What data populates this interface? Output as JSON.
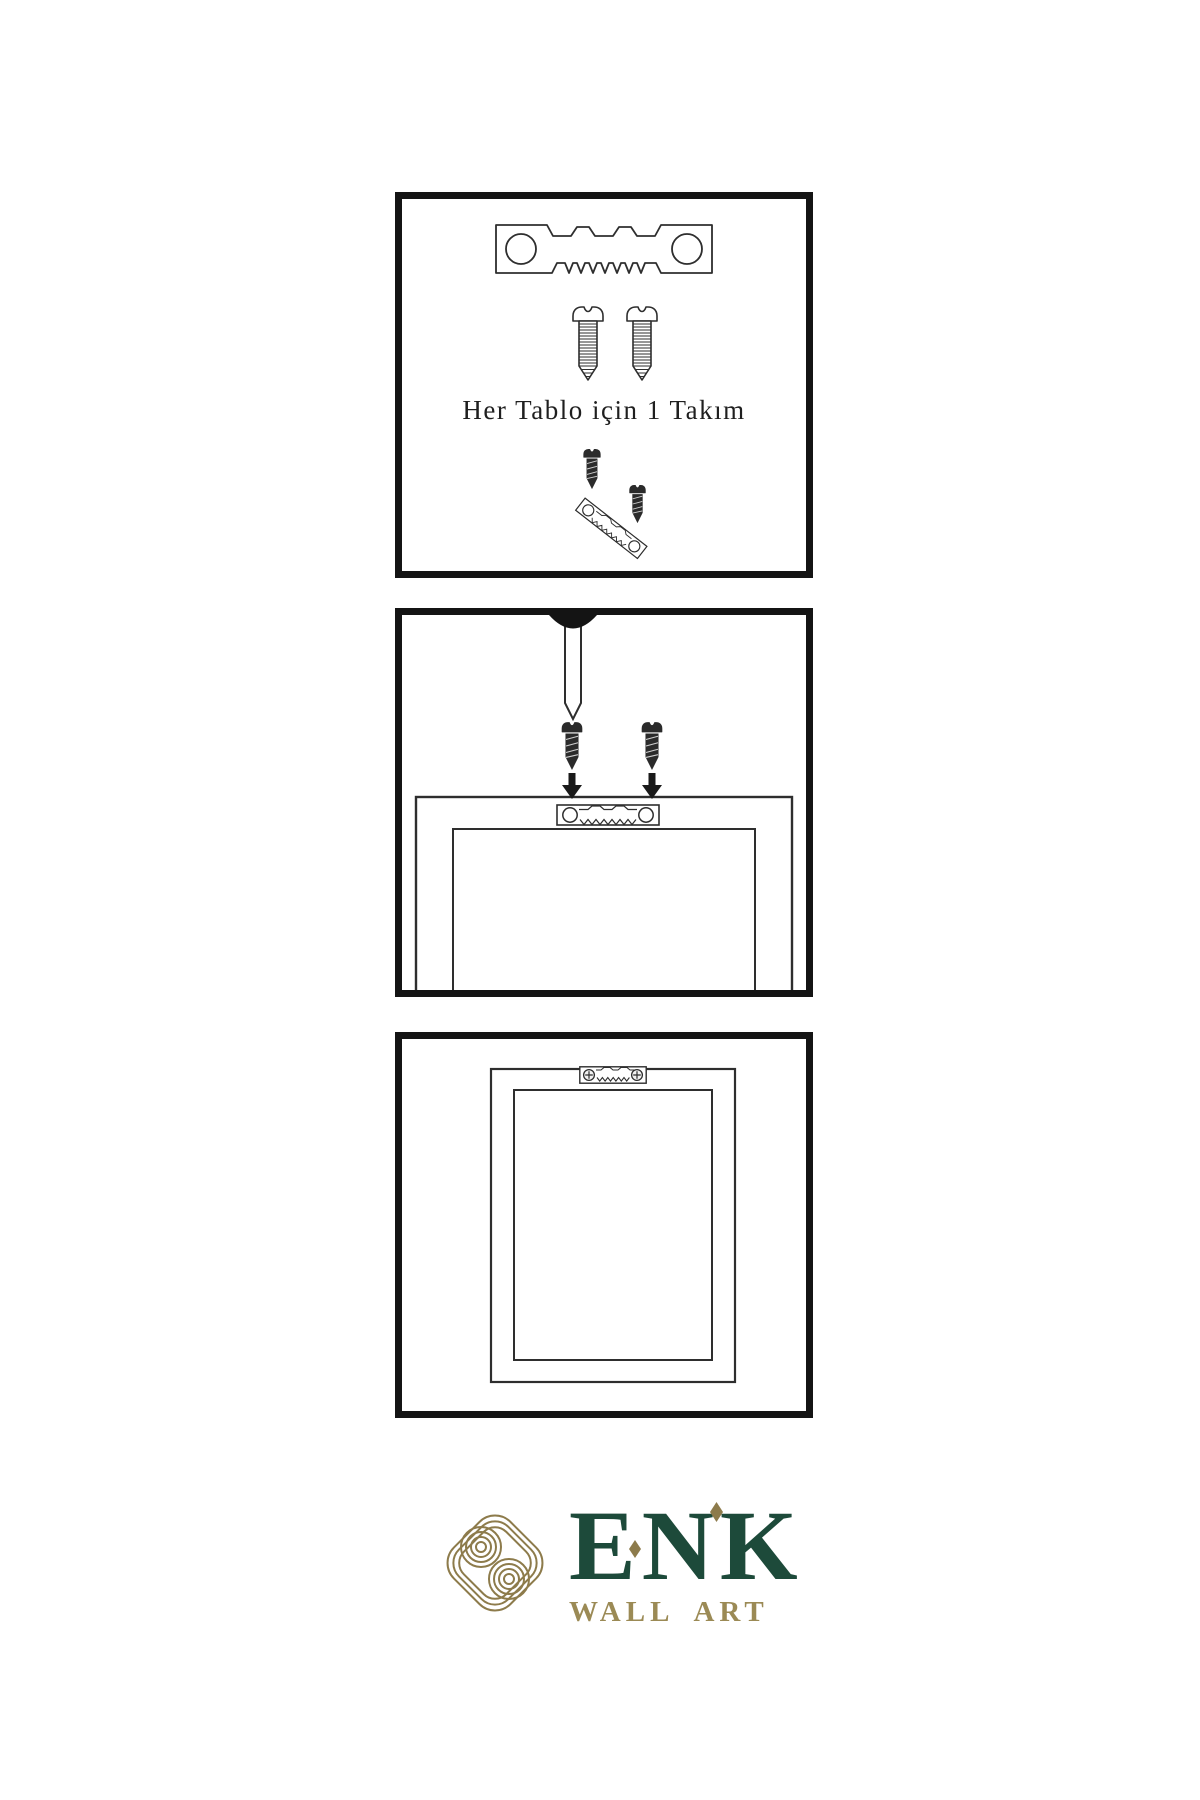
{
  "colors": {
    "background": "#ffffff",
    "panel_border": "#141414",
    "line_art": "#2e2e2e",
    "dark_fill": "#2b2b2b",
    "brand_green": "#1d4a3a",
    "brand_gold": "#8d7b4b",
    "tagline_gold": "#9b8a55"
  },
  "steps": [
    {
      "name": "hardware-set",
      "caption": "Her Tablo için 1 Takım",
      "icons": [
        "sawtooth-hanger-icon",
        "screw-icon",
        "screw-icon",
        "screw-into-hanger-icon"
      ]
    },
    {
      "name": "mount-hanger-on-frame",
      "icons": [
        "wall-nail-icon",
        "screw-icon",
        "screw-icon",
        "arrow-down-icon",
        "arrow-down-icon",
        "frame-back-icon",
        "sawtooth-hanger-icon"
      ]
    },
    {
      "name": "frame-mounted",
      "icons": [
        "frame-back-icon",
        "sawtooth-hanger-screwed-icon"
      ]
    }
  ],
  "brand": {
    "name": "ENK",
    "tagline": "WALL ART",
    "mark": "knot-icon"
  }
}
